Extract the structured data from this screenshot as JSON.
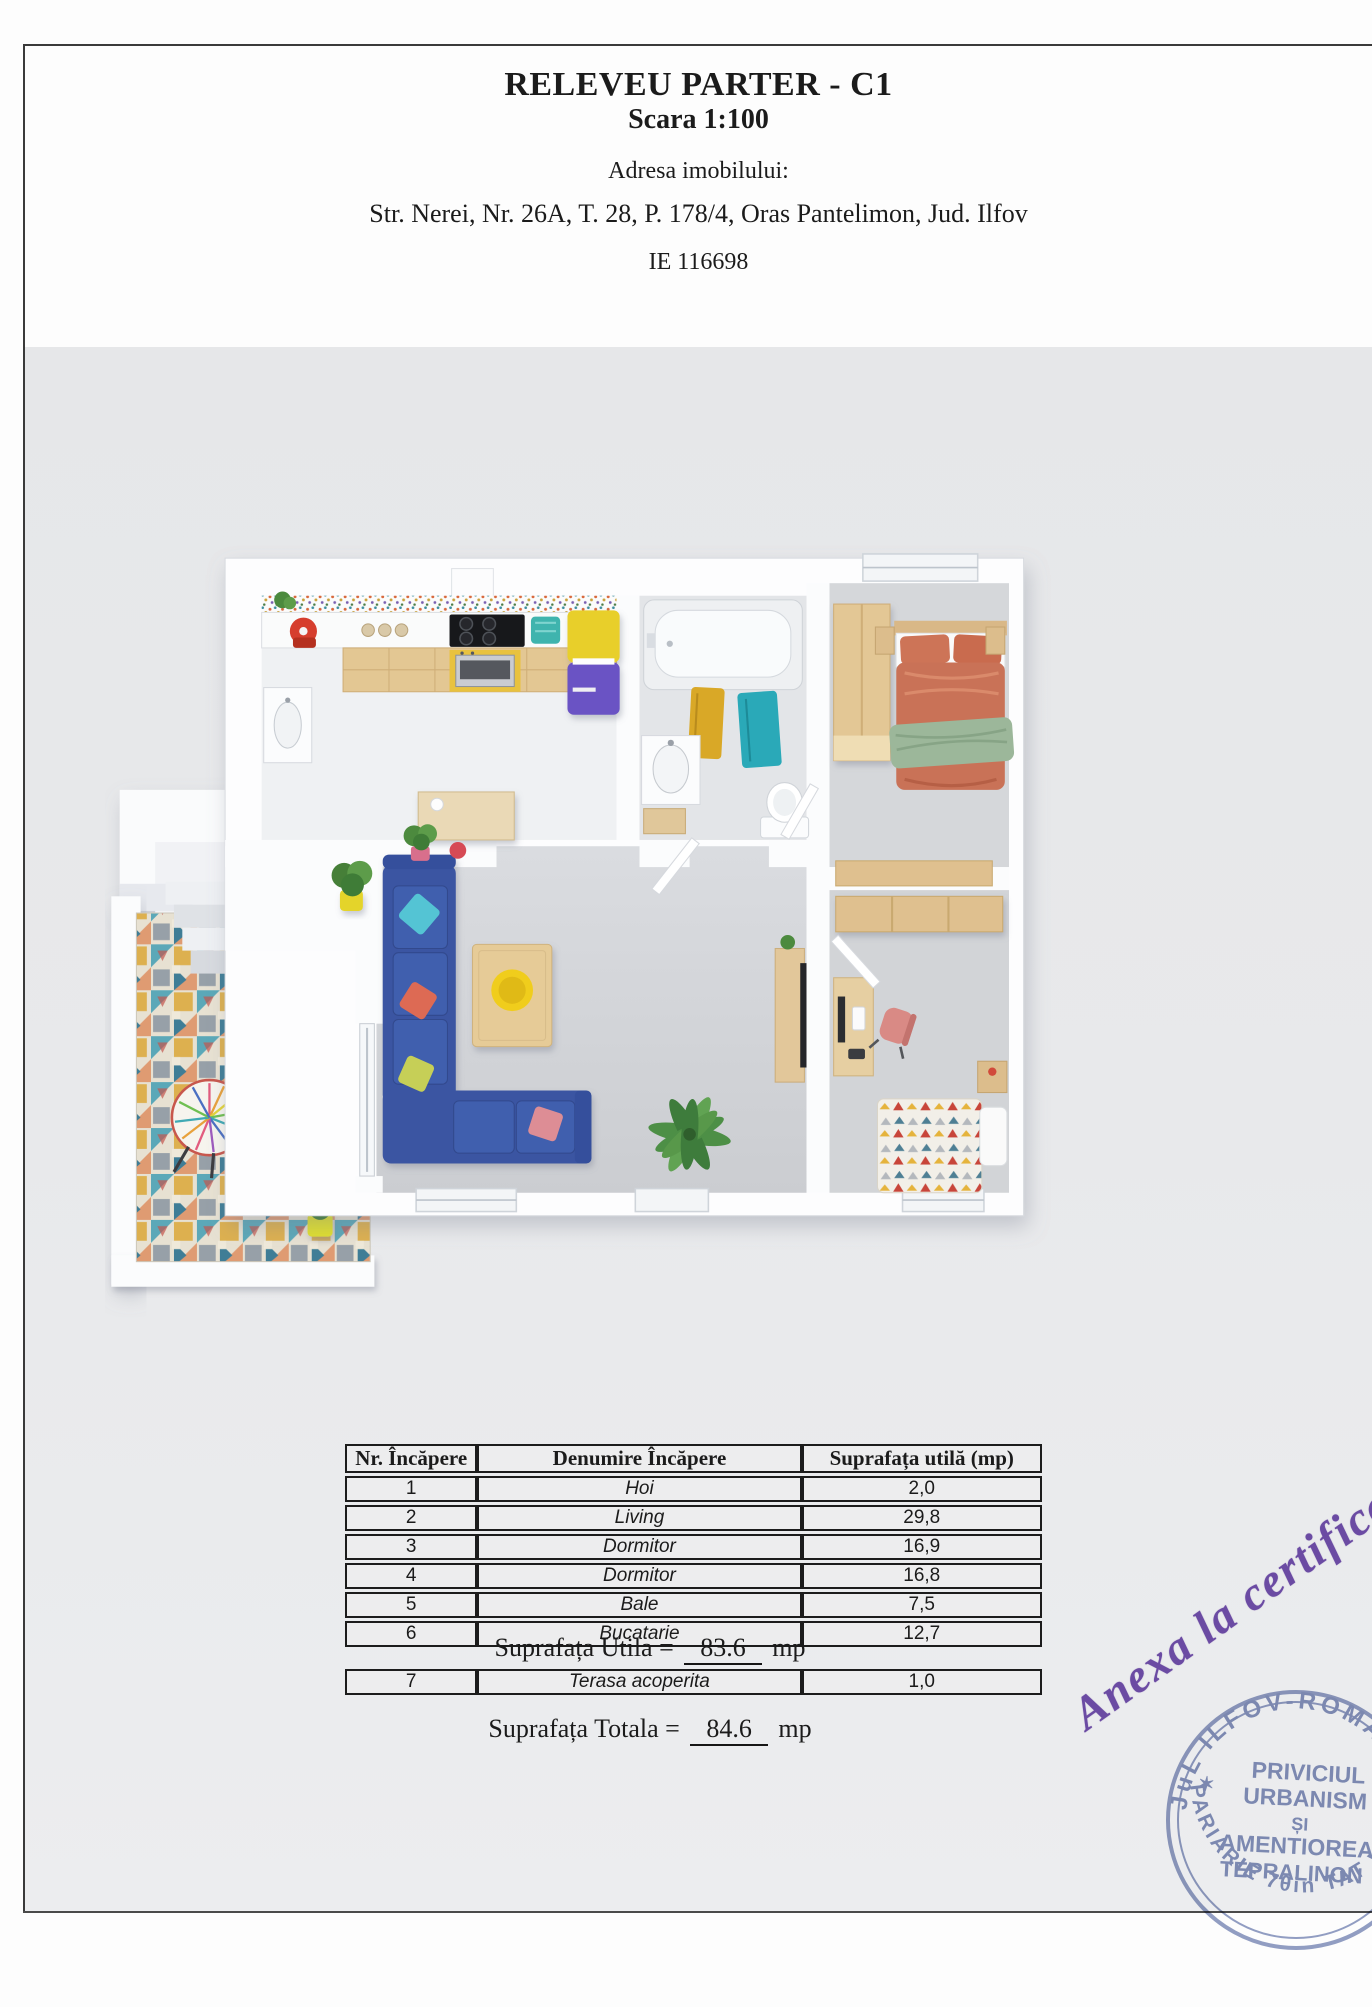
{
  "document": {
    "title": "RELEVEU PARTER - C1",
    "scale": "Scara 1:100",
    "address_label": "Adresa imobilului:",
    "address": "Str. Nerei, Nr. 26A, T. 28, P. 178/4, Oras Pantelimon, Jud. Ilfov",
    "cadastral_id": "IE 116698"
  },
  "areas_table": {
    "headers": [
      "Nr. Încăpere",
      "Denumire Încăpere",
      "Suprafața utilă (mp)"
    ],
    "rows": [
      {
        "nr": "1",
        "name": "Hoi",
        "area": "2,0"
      },
      {
        "nr": "2",
        "name": "Living",
        "area": "29,8"
      },
      {
        "nr": "3",
        "name": "Dormitor",
        "area": "16,9"
      },
      {
        "nr": "4",
        "name": "Dormitor",
        "area": "16,8"
      },
      {
        "nr": "5",
        "name": "Bale",
        "area": "7,5"
      },
      {
        "nr": "6",
        "name": "Bucatarie",
        "area": "12,7"
      }
    ],
    "useful_area_label": "Suprafața Utila =",
    "useful_area_value": "83.6",
    "useful_area_unit": "mp",
    "extra_row": {
      "nr": "7",
      "name": "Terasa acoperita",
      "area": "1,0"
    },
    "total_area_label": "Suprafața Totala =",
    "total_area_value": "84.6",
    "total_area_unit": "mp"
  },
  "annotations": {
    "handwritten_note": "Anexa la certificat",
    "ink_color": "#6b4ba3"
  },
  "stamp": {
    "arc_top": "JuL ILFOV-ROMAN",
    "arc_bottom": "PARIARIE 7θin TAT VELTAC",
    "star": "✶",
    "center_lines": [
      "PRIVICIUL",
      "URBANISM",
      "ȘI",
      "AMENTIOREA",
      "TEPRALINON"
    ],
    "color": "#7d8bb8"
  }
}
